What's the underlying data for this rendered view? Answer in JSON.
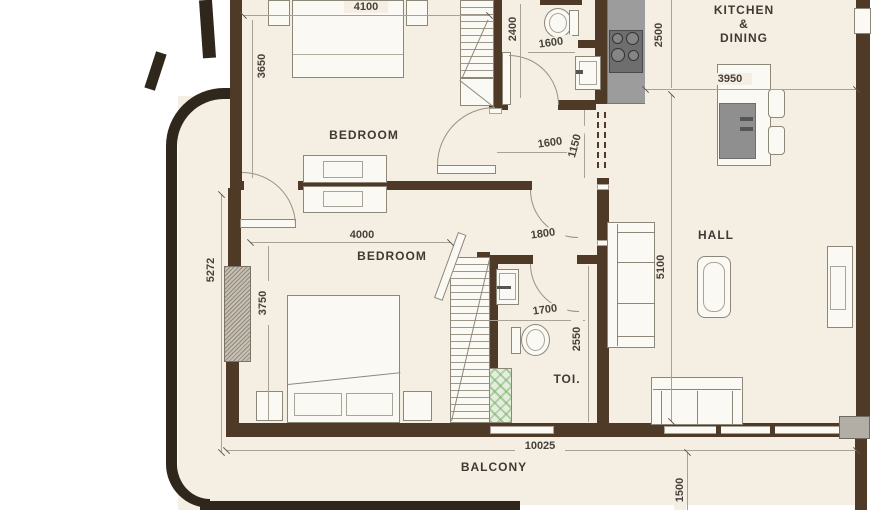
{
  "floorplan": {
    "rooms": {
      "bedroom_top": "BEDROOM",
      "bedroom_bottom": "BEDROOM",
      "kitchen_line1": "KITCHEN",
      "kitchen_line2": "&",
      "kitchen_line3": "DINING",
      "hall": "HALL",
      "toilet": "TOI.",
      "balcony": "BALCONY"
    },
    "dimensions": {
      "d4100": "4100",
      "d3650": "3650",
      "d2400": "2400",
      "d1600_top": "1600",
      "d2500": "2500",
      "d3950": "3950",
      "d1600_mid": "1600",
      "d1150": "1150",
      "d1800": "1800",
      "d4000": "4000",
      "d5272": "5272",
      "d3750": "3750",
      "d1700": "1700",
      "d2550": "2550",
      "d5100": "5100",
      "d10025": "10025",
      "d1500": "1500"
    },
    "colors": {
      "wall": "#4e3a27",
      "outline": "#2f261c",
      "floor": "#f5eee3",
      "counter": "#9c9c9c",
      "furniture_line": "#8d8779",
      "text": "#46413a",
      "shaft_green": "#a8cf98"
    }
  }
}
